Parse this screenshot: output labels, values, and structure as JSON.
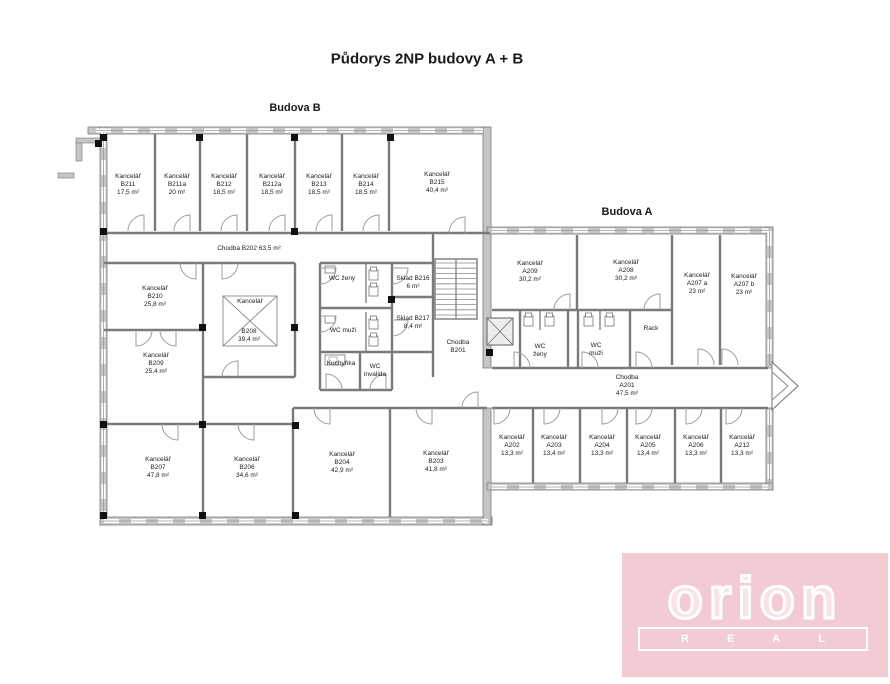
{
  "title": "Půdorys 2NP budovy A + B",
  "buildings": {
    "b": "Budova B",
    "a": "Budova A"
  },
  "labels": [
    {
      "id": "kancelar-b211",
      "lines": [
        "Kancelář",
        "B211",
        "17,5 m²"
      ],
      "x": 128,
      "y": 185
    },
    {
      "id": "kancelar-b211a",
      "lines": [
        "Kancelář",
        "B211a",
        "20 m²"
      ],
      "x": 177,
      "y": 185
    },
    {
      "id": "kancelar-b212",
      "lines": [
        "Kancelář",
        "B212",
        "18,5 m²"
      ],
      "x": 224,
      "y": 185
    },
    {
      "id": "kancelar-b212a",
      "lines": [
        "Kancelář",
        "B212a",
        "18,5 m²"
      ],
      "x": 272,
      "y": 185
    },
    {
      "id": "kancelar-b213",
      "lines": [
        "Kancelář",
        "B213",
        "18,5 m²"
      ],
      "x": 319,
      "y": 185
    },
    {
      "id": "kancelar-b214",
      "lines": [
        "Kancelář",
        "B214",
        "18,5 m²"
      ],
      "x": 366,
      "y": 185
    },
    {
      "id": "kancelar-b215",
      "lines": [
        "Kancelář",
        "B215",
        "40,4 m²"
      ],
      "x": 437,
      "y": 183
    },
    {
      "id": "chodba-b202",
      "lines": [
        "Chodba B202 63,5 m²"
      ],
      "x": 249,
      "y": 249
    },
    {
      "id": "kancelar-b210",
      "lines": [
        "Kancelář",
        "B210",
        "25,8 m²"
      ],
      "x": 155,
      "y": 297
    },
    {
      "id": "kancelar-b208-name",
      "lines": [
        "Kancelář"
      ],
      "x": 250,
      "y": 302
    },
    {
      "id": "kancelar-b208-area",
      "lines": [
        "B208",
        "39,4 m²"
      ],
      "x": 249,
      "y": 336
    },
    {
      "id": "kancelar-b209",
      "lines": [
        "Kancelář",
        "B209",
        "25,4 m²"
      ],
      "x": 156,
      "y": 364
    },
    {
      "id": "wc-zeny-b",
      "lines": [
        "WC ženy"
      ],
      "x": 342,
      "y": 279
    },
    {
      "id": "wc-muzi-b",
      "lines": [
        "WC muži"
      ],
      "x": 343,
      "y": 331
    },
    {
      "id": "kuchynka",
      "lines": [
        "Kuchyňka"
      ],
      "x": 341,
      "y": 364
    },
    {
      "id": "wc-invalida",
      "lines": [
        "WC",
        "invalida"
      ],
      "x": 375,
      "y": 371
    },
    {
      "id": "sklad-b216",
      "lines": [
        "Sklad B216",
        "6 m²"
      ],
      "x": 413,
      "y": 283
    },
    {
      "id": "sklad-b217",
      "lines": [
        "Sklad B217",
        "8,4 m²"
      ],
      "x": 413,
      "y": 323
    },
    {
      "id": "chodba-b201",
      "lines": [
        "Chodba",
        "B201"
      ],
      "x": 458,
      "y": 347
    },
    {
      "id": "kancelar-b207",
      "lines": [
        "Kancelář",
        "B207",
        "47,8 m²"
      ],
      "x": 158,
      "y": 468
    },
    {
      "id": "kancelar-b206",
      "lines": [
        "Kancelář",
        "B206",
        "34,6 m²"
      ],
      "x": 247,
      "y": 468
    },
    {
      "id": "kancelar-b204",
      "lines": [
        "Kancelář",
        "B204",
        "42,9  m²"
      ],
      "x": 342,
      "y": 463
    },
    {
      "id": "kancelar-b203",
      "lines": [
        "Kancelář",
        "B203",
        "41,8 m²"
      ],
      "x": 436,
      "y": 462
    },
    {
      "id": "kancelar-a209",
      "lines": [
        "Kancelář",
        "A209",
        "30,2 m²"
      ],
      "x": 530,
      "y": 272
    },
    {
      "id": "kancelar-a208",
      "lines": [
        "Kancelář",
        "A208",
        "30,2 m²"
      ],
      "x": 626,
      "y": 271
    },
    {
      "id": "kancelar-a207a",
      "lines": [
        "Kancelář",
        "A207 a",
        "23 m²"
      ],
      "x": 697,
      "y": 284
    },
    {
      "id": "kancelar-a207b",
      "lines": [
        "Kancelář",
        "A207 b",
        "23 m²"
      ],
      "x": 744,
      "y": 285
    },
    {
      "id": "rack",
      "lines": [
        "Rack"
      ],
      "x": 651,
      "y": 329
    },
    {
      "id": "wc-zeny-a",
      "lines": [
        "WC",
        "ženy"
      ],
      "x": 540,
      "y": 351
    },
    {
      "id": "wc-muzi-a",
      "lines": [
        "WC",
        "muži"
      ],
      "x": 596,
      "y": 350
    },
    {
      "id": "chodba-a201",
      "lines": [
        "Chodba",
        "A201",
        "47,5 m²"
      ],
      "x": 627,
      "y": 386
    },
    {
      "id": "kancelar-a202",
      "lines": [
        "Kancelář",
        "A202",
        "13,3 m²"
      ],
      "x": 512,
      "y": 446
    },
    {
      "id": "kancelar-a203",
      "lines": [
        "Kancelář",
        "A203",
        "13,4 m²"
      ],
      "x": 554,
      "y": 446
    },
    {
      "id": "kancelar-a204",
      "lines": [
        "Kancelář",
        "A204",
        "13,3 m²"
      ],
      "x": 602,
      "y": 446
    },
    {
      "id": "kancelar-a205",
      "lines": [
        "Kancelář",
        "A205",
        "13,4 m²"
      ],
      "x": 648,
      "y": 446
    },
    {
      "id": "kancelar-a206",
      "lines": [
        "Kancelář",
        "A206",
        "13,3 m²"
      ],
      "x": 696,
      "y": 446
    },
    {
      "id": "kancelar-a212",
      "lines": [
        "Kancelář",
        "A212",
        "13,3 m²"
      ],
      "x": 742,
      "y": 446
    }
  ],
  "logo": {
    "brand": "orion",
    "sub": "REAL",
    "bg": "#f3ccd3",
    "fg": "#ffffff"
  },
  "plan": {
    "colors": {
      "wall": "#7a7a7a",
      "outer_fill": "#c6c6c6",
      "door": "#9c9c9c",
      "window_line": "#999999",
      "column": "#111111"
    },
    "outer": [
      [
        88,
        127,
        402,
        7
      ],
      [
        100,
        127,
        7,
        398
      ],
      [
        100,
        517,
        392,
        8
      ],
      [
        483,
        127,
        8,
        241
      ],
      [
        483,
        408,
        8,
        117
      ],
      [
        487,
        227,
        286,
        7
      ],
      [
        766,
        227,
        7,
        141
      ],
      [
        766,
        408,
        7,
        82
      ],
      [
        487,
        483,
        286,
        7
      ]
    ],
    "windows": [
      [
        96,
        130.5,
        483,
        130.5
      ],
      [
        103.5,
        133,
        103.5,
        517
      ],
      [
        104,
        521,
        488,
        521
      ],
      [
        492,
        230.5,
        768,
        230.5
      ],
      [
        492,
        487,
        768,
        487
      ],
      [
        769.5,
        231,
        769.5,
        366
      ],
      [
        769.5,
        410,
        769.5,
        485
      ]
    ],
    "walls": [
      [
        155,
        134,
        155,
        231
      ],
      [
        200,
        134,
        200,
        231
      ],
      [
        247,
        134,
        247,
        231
      ],
      [
        295,
        134,
        295,
        231
      ],
      [
        342,
        134,
        342,
        231
      ],
      [
        389,
        134,
        389,
        231
      ],
      [
        104,
        233,
        490,
        233
      ],
      [
        104,
        263,
        295,
        263
      ],
      [
        320,
        263,
        433,
        263
      ],
      [
        203,
        263,
        203,
        517
      ],
      [
        295,
        263,
        295,
        377
      ],
      [
        203,
        377,
        295,
        377
      ],
      [
        104,
        330,
        203,
        330
      ],
      [
        104,
        424,
        293,
        424
      ],
      [
        293,
        408,
        487,
        408
      ],
      [
        293,
        408,
        293,
        517
      ],
      [
        390,
        408,
        390,
        517
      ],
      [
        320,
        263,
        320,
        390
      ],
      [
        392,
        263,
        392,
        390
      ],
      [
        320,
        308,
        392,
        308
      ],
      [
        320,
        352,
        392,
        352
      ],
      [
        320,
        390,
        392,
        390
      ],
      [
        360,
        352,
        360,
        390
      ],
      [
        433,
        233,
        433,
        377
      ],
      [
        392,
        297,
        433,
        297
      ],
      [
        392,
        352,
        433,
        352
      ],
      [
        577,
        235,
        577,
        310
      ],
      [
        672,
        235,
        672,
        365
      ],
      [
        720,
        235,
        720,
        365
      ],
      [
        492,
        310,
        672,
        310
      ],
      [
        492,
        368,
        768,
        368
      ],
      [
        492,
        408,
        768,
        408
      ],
      [
        520,
        310,
        520,
        368
      ],
      [
        568,
        310,
        568,
        368
      ],
      [
        578,
        310,
        578,
        368
      ],
      [
        630,
        310,
        630,
        368
      ],
      [
        533,
        408,
        533,
        483
      ],
      [
        580,
        408,
        580,
        483
      ],
      [
        627,
        408,
        627,
        483
      ],
      [
        675,
        408,
        675,
        483
      ],
      [
        721,
        408,
        721,
        483
      ]
    ],
    "thin_walls": [
      [
        366,
        263,
        366,
        303
      ],
      [
        366,
        312,
        366,
        352
      ],
      [
        540,
        310,
        540,
        330
      ],
      [
        600,
        310,
        600,
        330
      ]
    ],
    "columns": [
      [
        100,
        134
      ],
      [
        196,
        134
      ],
      [
        291,
        134
      ],
      [
        387,
        134
      ],
      [
        100,
        228
      ],
      [
        291,
        228
      ],
      [
        199,
        324
      ],
      [
        291,
        324
      ],
      [
        100,
        421
      ],
      [
        199,
        421
      ],
      [
        292,
        422
      ],
      [
        100,
        512
      ],
      [
        199,
        512
      ],
      [
        292,
        512
      ],
      [
        388,
        296
      ],
      [
        486,
        349
      ],
      [
        95,
        140
      ]
    ],
    "doors": [
      {
        "x": 144,
        "y": 231,
        "dy": -16,
        "dx": -16,
        "o": "v"
      },
      {
        "x": 190,
        "y": 231,
        "dy": -16,
        "dx": -16,
        "o": "v"
      },
      {
        "x": 237,
        "y": 231,
        "dy": -16,
        "dx": -16,
        "o": "v"
      },
      {
        "x": 285,
        "y": 231,
        "dy": -16,
        "dx": -16,
        "o": "v"
      },
      {
        "x": 332,
        "y": 231,
        "dy": -16,
        "dx": -16,
        "o": "v"
      },
      {
        "x": 379,
        "y": 231,
        "dy": -16,
        "dx": -16,
        "o": "v"
      },
      {
        "x": 465,
        "y": 233,
        "dy": -16,
        "dx": -16,
        "o": "v"
      },
      {
        "x": 196,
        "y": 263,
        "dy": 16,
        "dx": -16,
        "o": "v"
      },
      {
        "x": 136,
        "y": 330,
        "dy": 16,
        "dx": 16,
        "o": "v"
      },
      {
        "x": 176,
        "y": 330,
        "dy": 16,
        "dx": -16,
        "o": "v"
      },
      {
        "x": 222,
        "y": 263,
        "dy": 16,
        "dx": 16,
        "o": "v"
      },
      {
        "x": 238,
        "y": 377,
        "dy": -16,
        "dx": -16,
        "o": "v"
      },
      {
        "x": 178,
        "y": 424,
        "dy": 16,
        "dx": -16,
        "o": "v"
      },
      {
        "x": 254,
        "y": 424,
        "dy": 16,
        "dx": -16,
        "o": "v"
      },
      {
        "x": 330,
        "y": 408,
        "dy": 16,
        "dx": -16,
        "o": "v"
      },
      {
        "x": 432,
        "y": 408,
        "dy": 16,
        "dx": -16,
        "o": "v"
      },
      {
        "x": 478,
        "y": 408,
        "dy": -16,
        "dx": -16,
        "o": "v"
      },
      {
        "x": 326,
        "y": 390,
        "dy": -16,
        "dx": 16,
        "o": "v"
      },
      {
        "x": 386,
        "y": 390,
        "dy": -16,
        "dx": -16,
        "o": "v"
      },
      {
        "x": 570,
        "y": 310,
        "dy": -16,
        "dx": -16,
        "o": "v"
      },
      {
        "x": 660,
        "y": 310,
        "dy": -16,
        "dx": -16,
        "o": "v"
      },
      {
        "x": 698,
        "y": 365,
        "dy": -16,
        "dx": 16,
        "o": "v"
      },
      {
        "x": 722,
        "y": 365,
        "dy": -16,
        "dx": 16,
        "o": "v"
      },
      {
        "x": 636,
        "y": 368,
        "dy": -16,
        "dx": 16,
        "o": "v"
      },
      {
        "x": 514,
        "y": 368,
        "dy": -16,
        "dx": 16,
        "o": "v"
      },
      {
        "x": 582,
        "y": 368,
        "dy": -16,
        "dx": 16,
        "o": "v"
      },
      {
        "x": 494,
        "y": 408,
        "dy": 16,
        "dx": 16,
        "o": "v"
      },
      {
        "x": 544,
        "y": 408,
        "dy": 16,
        "dx": 16,
        "o": "v"
      },
      {
        "x": 602,
        "y": 408,
        "dy": 16,
        "dx": 16,
        "o": "v"
      },
      {
        "x": 636,
        "y": 408,
        "dy": 16,
        "dx": 16,
        "o": "v"
      },
      {
        "x": 686,
        "y": 408,
        "dy": 16,
        "dx": 16,
        "o": "v"
      },
      {
        "x": 726,
        "y": 408,
        "dy": 16,
        "dx": 16,
        "o": "v"
      },
      {
        "x": 392,
        "y": 268,
        "dx": 16,
        "dy": 16,
        "o": "h"
      },
      {
        "x": 392,
        "y": 320,
        "dx": 16,
        "dy": 16,
        "o": "h"
      },
      {
        "x": 320,
        "y": 268,
        "dx": 16,
        "dy": 16,
        "o": "h"
      },
      {
        "x": 320,
        "y": 316,
        "dx": 16,
        "dy": 16,
        "o": "h"
      }
    ],
    "stairs": {
      "x": 435,
      "y": 259,
      "w": 42,
      "h": 60,
      "treads": 11
    },
    "elevator": {
      "x": 487,
      "y": 318,
      "w": 26,
      "h": 27
    },
    "skylight": {
      "x": 223,
      "y": 296,
      "w": 54,
      "h": 50
    },
    "arrow": {
      "outer": [
        [
          772,
          362
        ],
        [
          798,
          386
        ],
        [
          772,
          410
        ]
      ],
      "inner": [
        [
          772,
          372
        ],
        [
          788,
          386
        ],
        [
          772,
          400
        ]
      ]
    },
    "fixtures": [
      [
        369,
        267
      ],
      [
        369,
        283
      ],
      [
        369,
        316
      ],
      [
        369,
        333
      ],
      [
        524,
        313
      ],
      [
        545,
        313
      ],
      [
        584,
        313
      ],
      [
        605,
        313
      ]
    ],
    "sinks": [
      [
        325,
        266
      ],
      [
        325,
        316
      ]
    ],
    "counter": [
      325,
      355,
      20,
      10
    ],
    "extras": [
      [
        76,
        138,
        26,
        5
      ],
      [
        76,
        143,
        6,
        18
      ],
      [
        58,
        173,
        16,
        5
      ]
    ]
  }
}
